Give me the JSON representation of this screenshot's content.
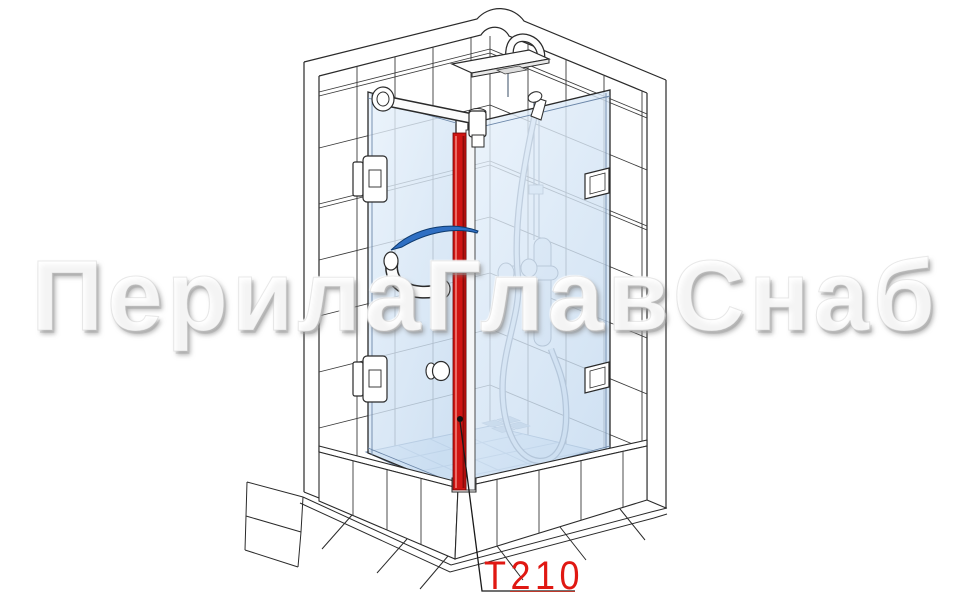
{
  "page": {
    "width": 970,
    "height": 606,
    "background": "#ffffff"
  },
  "watermark": {
    "text": "ПерилаГлавСнаб"
  },
  "callout": {
    "part_code": "T210",
    "text_color": "#e01812"
  },
  "icons": {
    "door_swing_arrow": "door-swing-arrow"
  },
  "colors": {
    "profile_red": "#cf1513",
    "profile_red_dark": "#8c0a08",
    "profile_red_highlight": "#f2827a",
    "arrow_blue": "#2f6fc3",
    "glass_blue_light": "#e7f1fb",
    "glass_blue_dark": "#c6dbf0",
    "line_color": "#2a2a2a",
    "tray_tile_line": "#9db3cd"
  }
}
